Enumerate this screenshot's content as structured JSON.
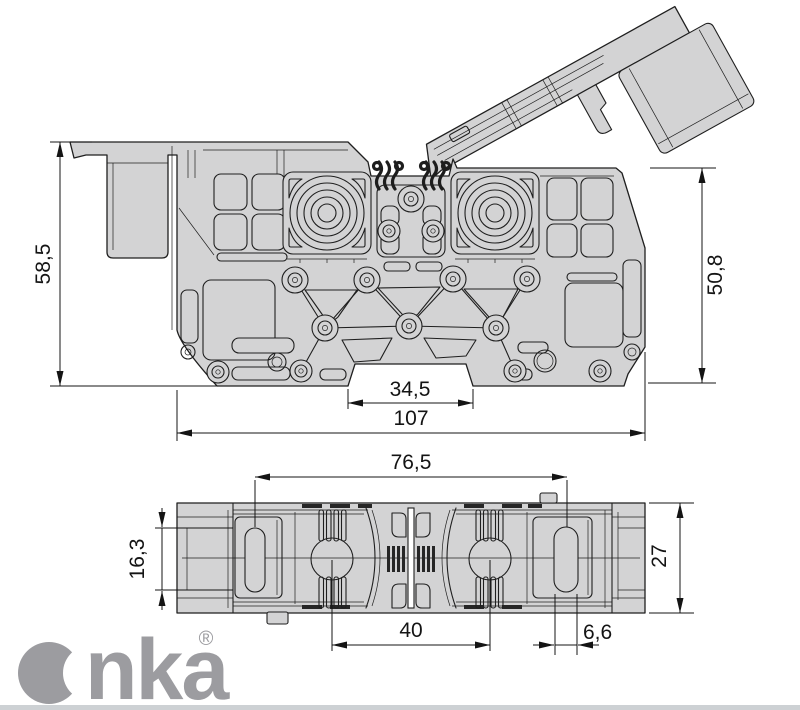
{
  "logo": {
    "text": "Onka",
    "wordmark_rest": "nka",
    "registered_symbol": "®",
    "color": "#9c9ca0"
  },
  "dimensions": {
    "side_view": {
      "overall_height": "58,5",
      "body_height": "50,8",
      "din_notch_width": "34,5",
      "overall_width": "107"
    },
    "bottom_view": {
      "slot_center_span": "76,5",
      "slot_length": "16,3",
      "body_depth": "27",
      "comb_center_span": "40",
      "slot_width": "6,6"
    }
  },
  "colors": {
    "background": "#ffffff",
    "body_fill": "#d3d3d4",
    "outline": "#1f1f1f",
    "dimension": "#141414",
    "logo": "#9c9ca0",
    "divider": "#cdd1d4"
  }
}
